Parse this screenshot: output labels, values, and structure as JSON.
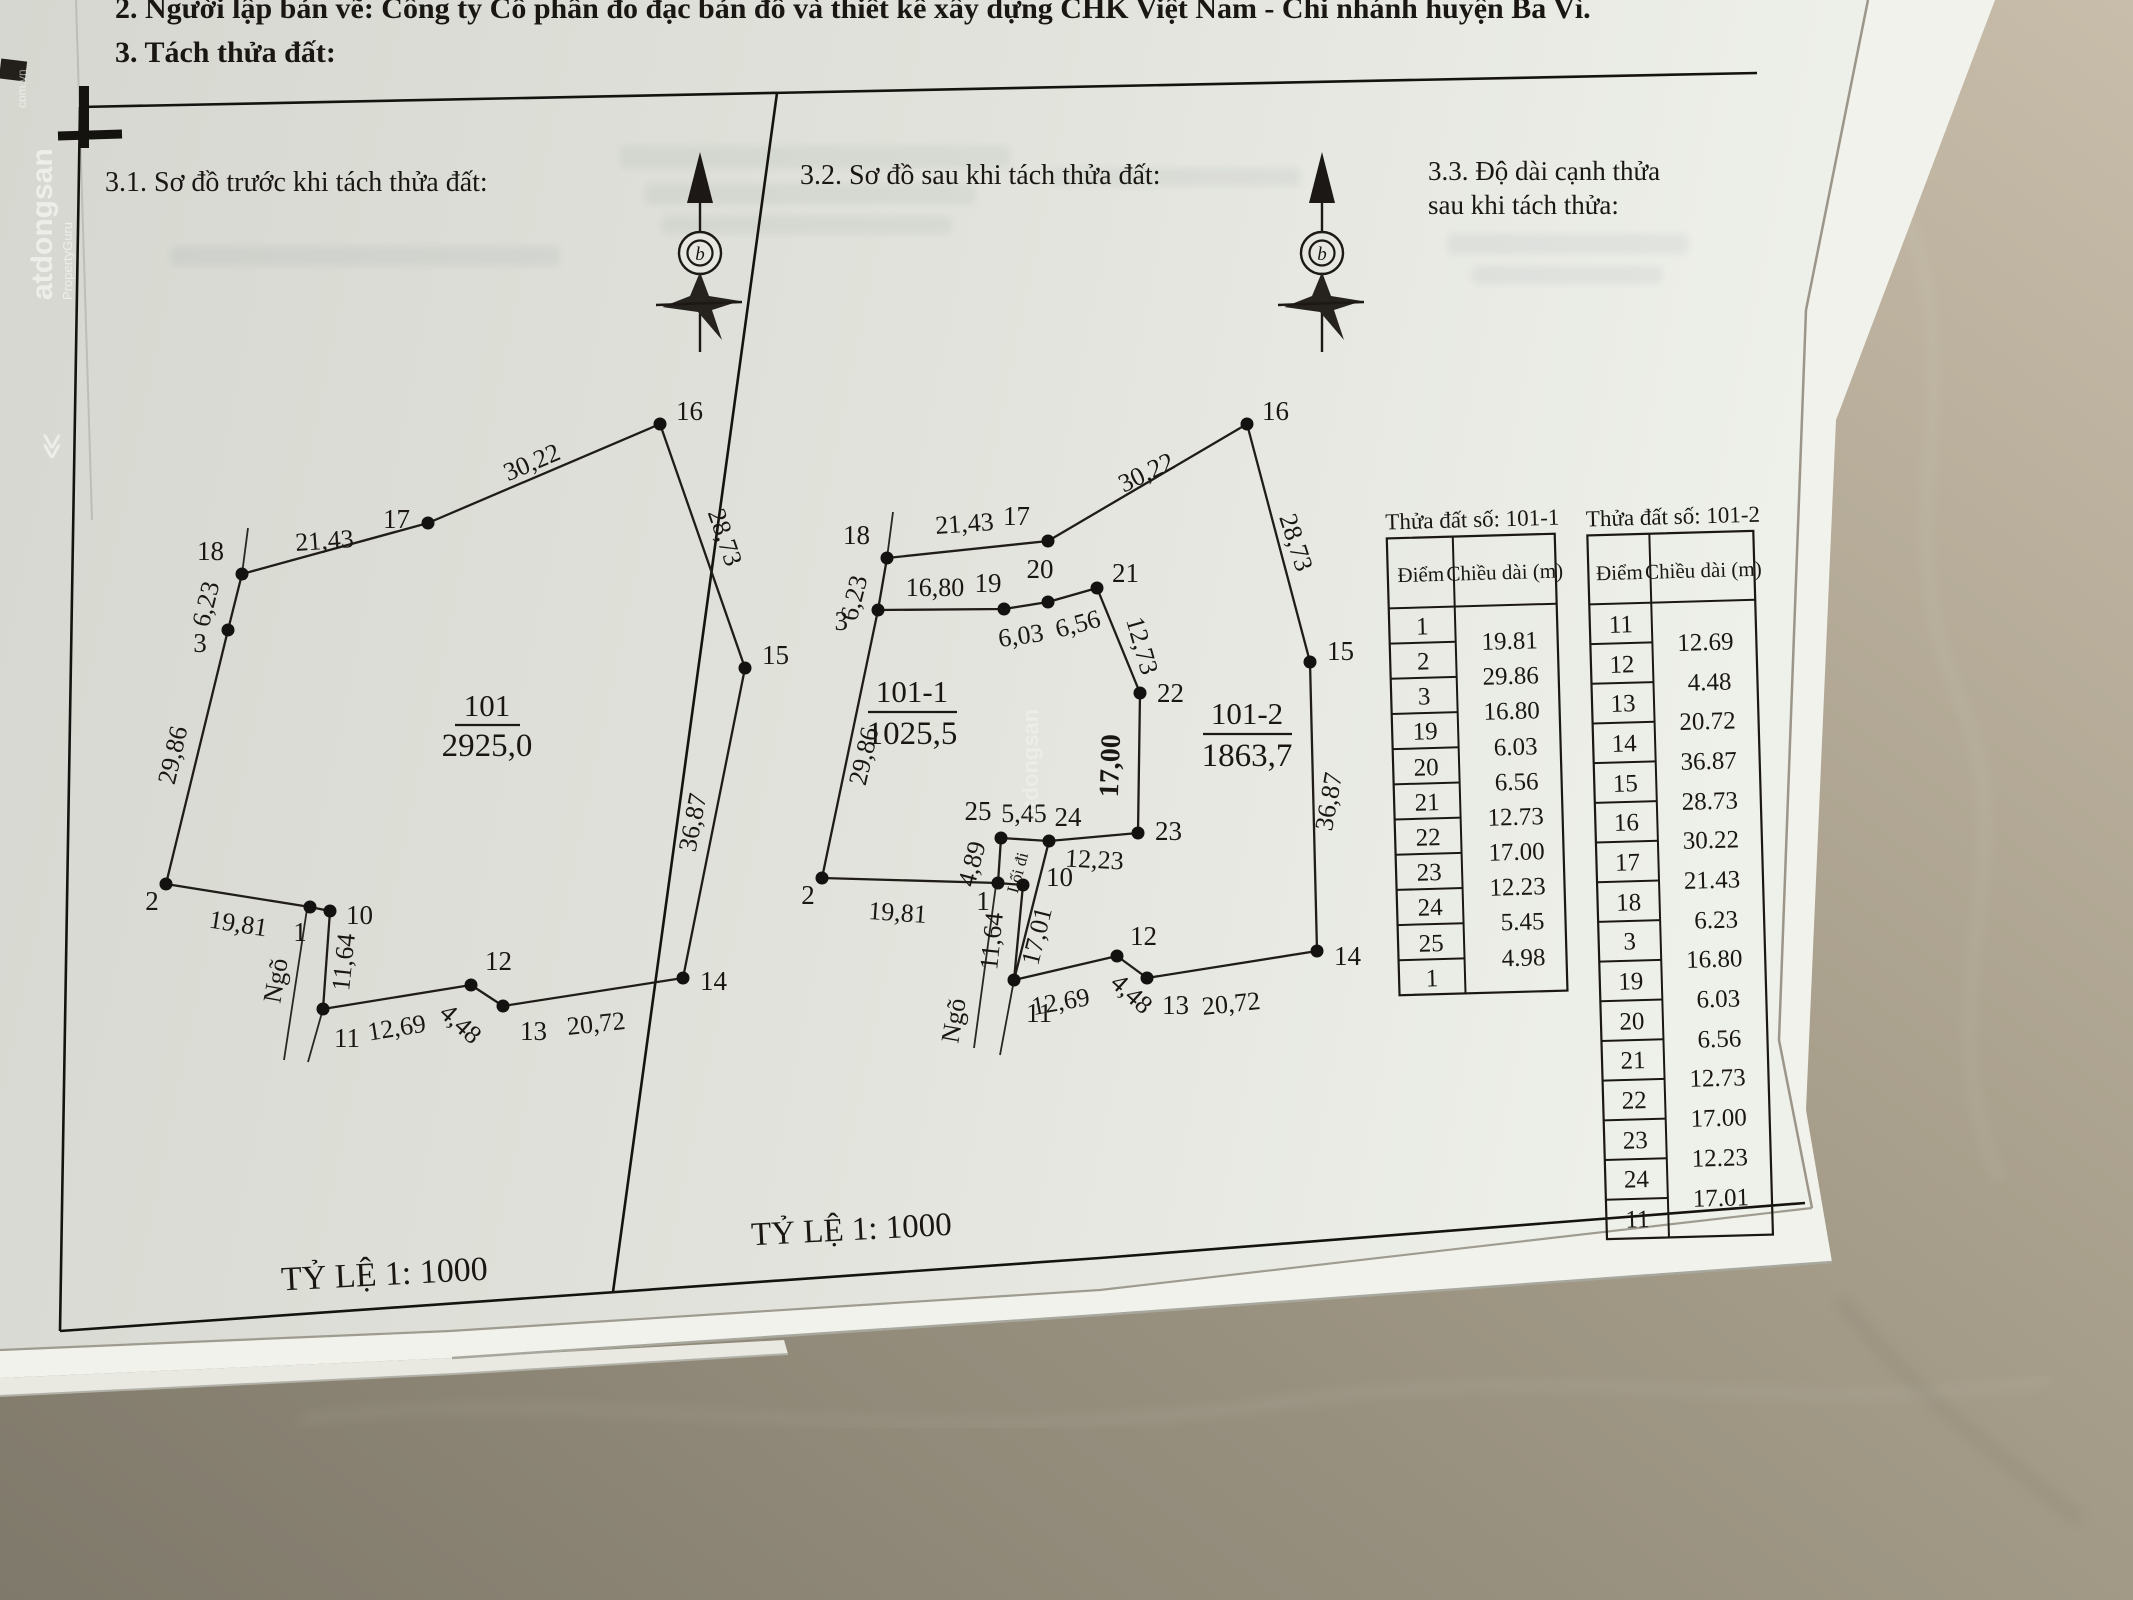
{
  "photo": {
    "header_line1": "2. Người lập bản vẽ: Công ty Cổ phần đo đạc bản đồ và thiết kế xây dựng CHK Việt Nam - Chi nhánh huyện Ba Vì.",
    "header_line2": "3. Tách thửa đất:"
  },
  "sections": {
    "s1_title": "3.1. Sơ đồ trước khi  tách thửa đất:",
    "s2_title": "3.2. Sơ đồ sau khi tách thửa đất:",
    "s3_title1": "3.3. Độ dài cạnh thửa",
    "s3_title2": "sau khi tách thửa:",
    "scale_left": "TỶ LỆ 1: 1000",
    "scale_right": "TỶ LỆ 1: 1000"
  },
  "compass": {
    "letter": "b"
  },
  "watermark": {
    "brand": "atdongsan",
    "domain": "com.vn",
    "partner": "PropertyGuru",
    "chevron": "≪"
  },
  "before": {
    "plot_id": "101",
    "plot_area": "2925,0",
    "alley": "Ngõ",
    "v": {
      "p1": "1",
      "p2": "2",
      "p3": "3",
      "p10": "10",
      "p11": "11",
      "p12": "12",
      "p13": "13",
      "p14": "14",
      "p15": "15",
      "p16": "16",
      "p17": "17",
      "p18": "18"
    },
    "e": {
      "e2_1": "19,81",
      "e2_3": "29,86",
      "e3_18": "6,23",
      "e18_17": "21,43",
      "e17_16": "30,22",
      "e16_15": "28,73",
      "e15_14": "36,87",
      "e14_13": "20,72",
      "e13_12": "4,48",
      "e12_11": "12,69",
      "e10_11": "11,64"
    }
  },
  "after": {
    "plot1_id": "101-1",
    "plot1_area": "1025,5",
    "plot2_id": "101-2",
    "plot2_area": "1863,7",
    "alley": "Ngõ",
    "walkway": "Lối đi",
    "v": {
      "p1": "1",
      "p2": "2",
      "p3": "3",
      "p10": "10",
      "p11": "11",
      "p12": "12",
      "p13": "13",
      "p14": "14",
      "p15": "15",
      "p16": "16",
      "p17": "17",
      "p18": "18",
      "p19": "19",
      "p20": "20",
      "p21": "21",
      "p22": "22",
      "p23": "23",
      "p24": "24",
      "p25": "25"
    },
    "e": {
      "e2_1": "19,81",
      "e2_3": "29,86",
      "e3_18": "6,23",
      "e18_17": "21,43",
      "e17_16": "30,22",
      "e16_15": "28,73",
      "e15_14": "36,87",
      "e14_13": "20,72",
      "e13_12": "4,48",
      "e12_11": "12,69",
      "e10_11": "11,64",
      "e3_19": "16,80",
      "e19_20": "6,03",
      "e20_21": "6,56",
      "e21_22": "12,73",
      "e22_23": "17,00",
      "e23_24": "12,23",
      "e24_25": "5,45",
      "e25_1": "4,89",
      "e24_11": "17,01"
    }
  },
  "tables": {
    "t1": {
      "title": "Thửa đất số: 101-1",
      "col_point": "Điểm",
      "col_length": "Chiều dài (m)",
      "points": [
        "1",
        "2",
        "3",
        "19",
        "20",
        "21",
        "22",
        "23",
        "24",
        "25",
        "1"
      ],
      "lengths": [
        "19.81",
        "29.86",
        "16.80",
        "6.03",
        "6.56",
        "12.73",
        "17.00",
        "12.23",
        "5.45",
        "4.98"
      ]
    },
    "t2": {
      "title": "Thửa đất số: 101-2",
      "col_point": "Điểm",
      "col_length": "Chiều dài (m)",
      "points": [
        "11",
        "12",
        "13",
        "14",
        "15",
        "16",
        "17",
        "18",
        "3",
        "19",
        "20",
        "21",
        "22",
        "23",
        "24",
        "11"
      ],
      "lengths": [
        "12.69",
        "4.48",
        "20.72",
        "36.87",
        "28.73",
        "30.22",
        "21.43",
        "6.23",
        "16.80",
        "6.03",
        "6.56",
        "12.73",
        "17.00",
        "12.23",
        "17.01"
      ]
    }
  }
}
